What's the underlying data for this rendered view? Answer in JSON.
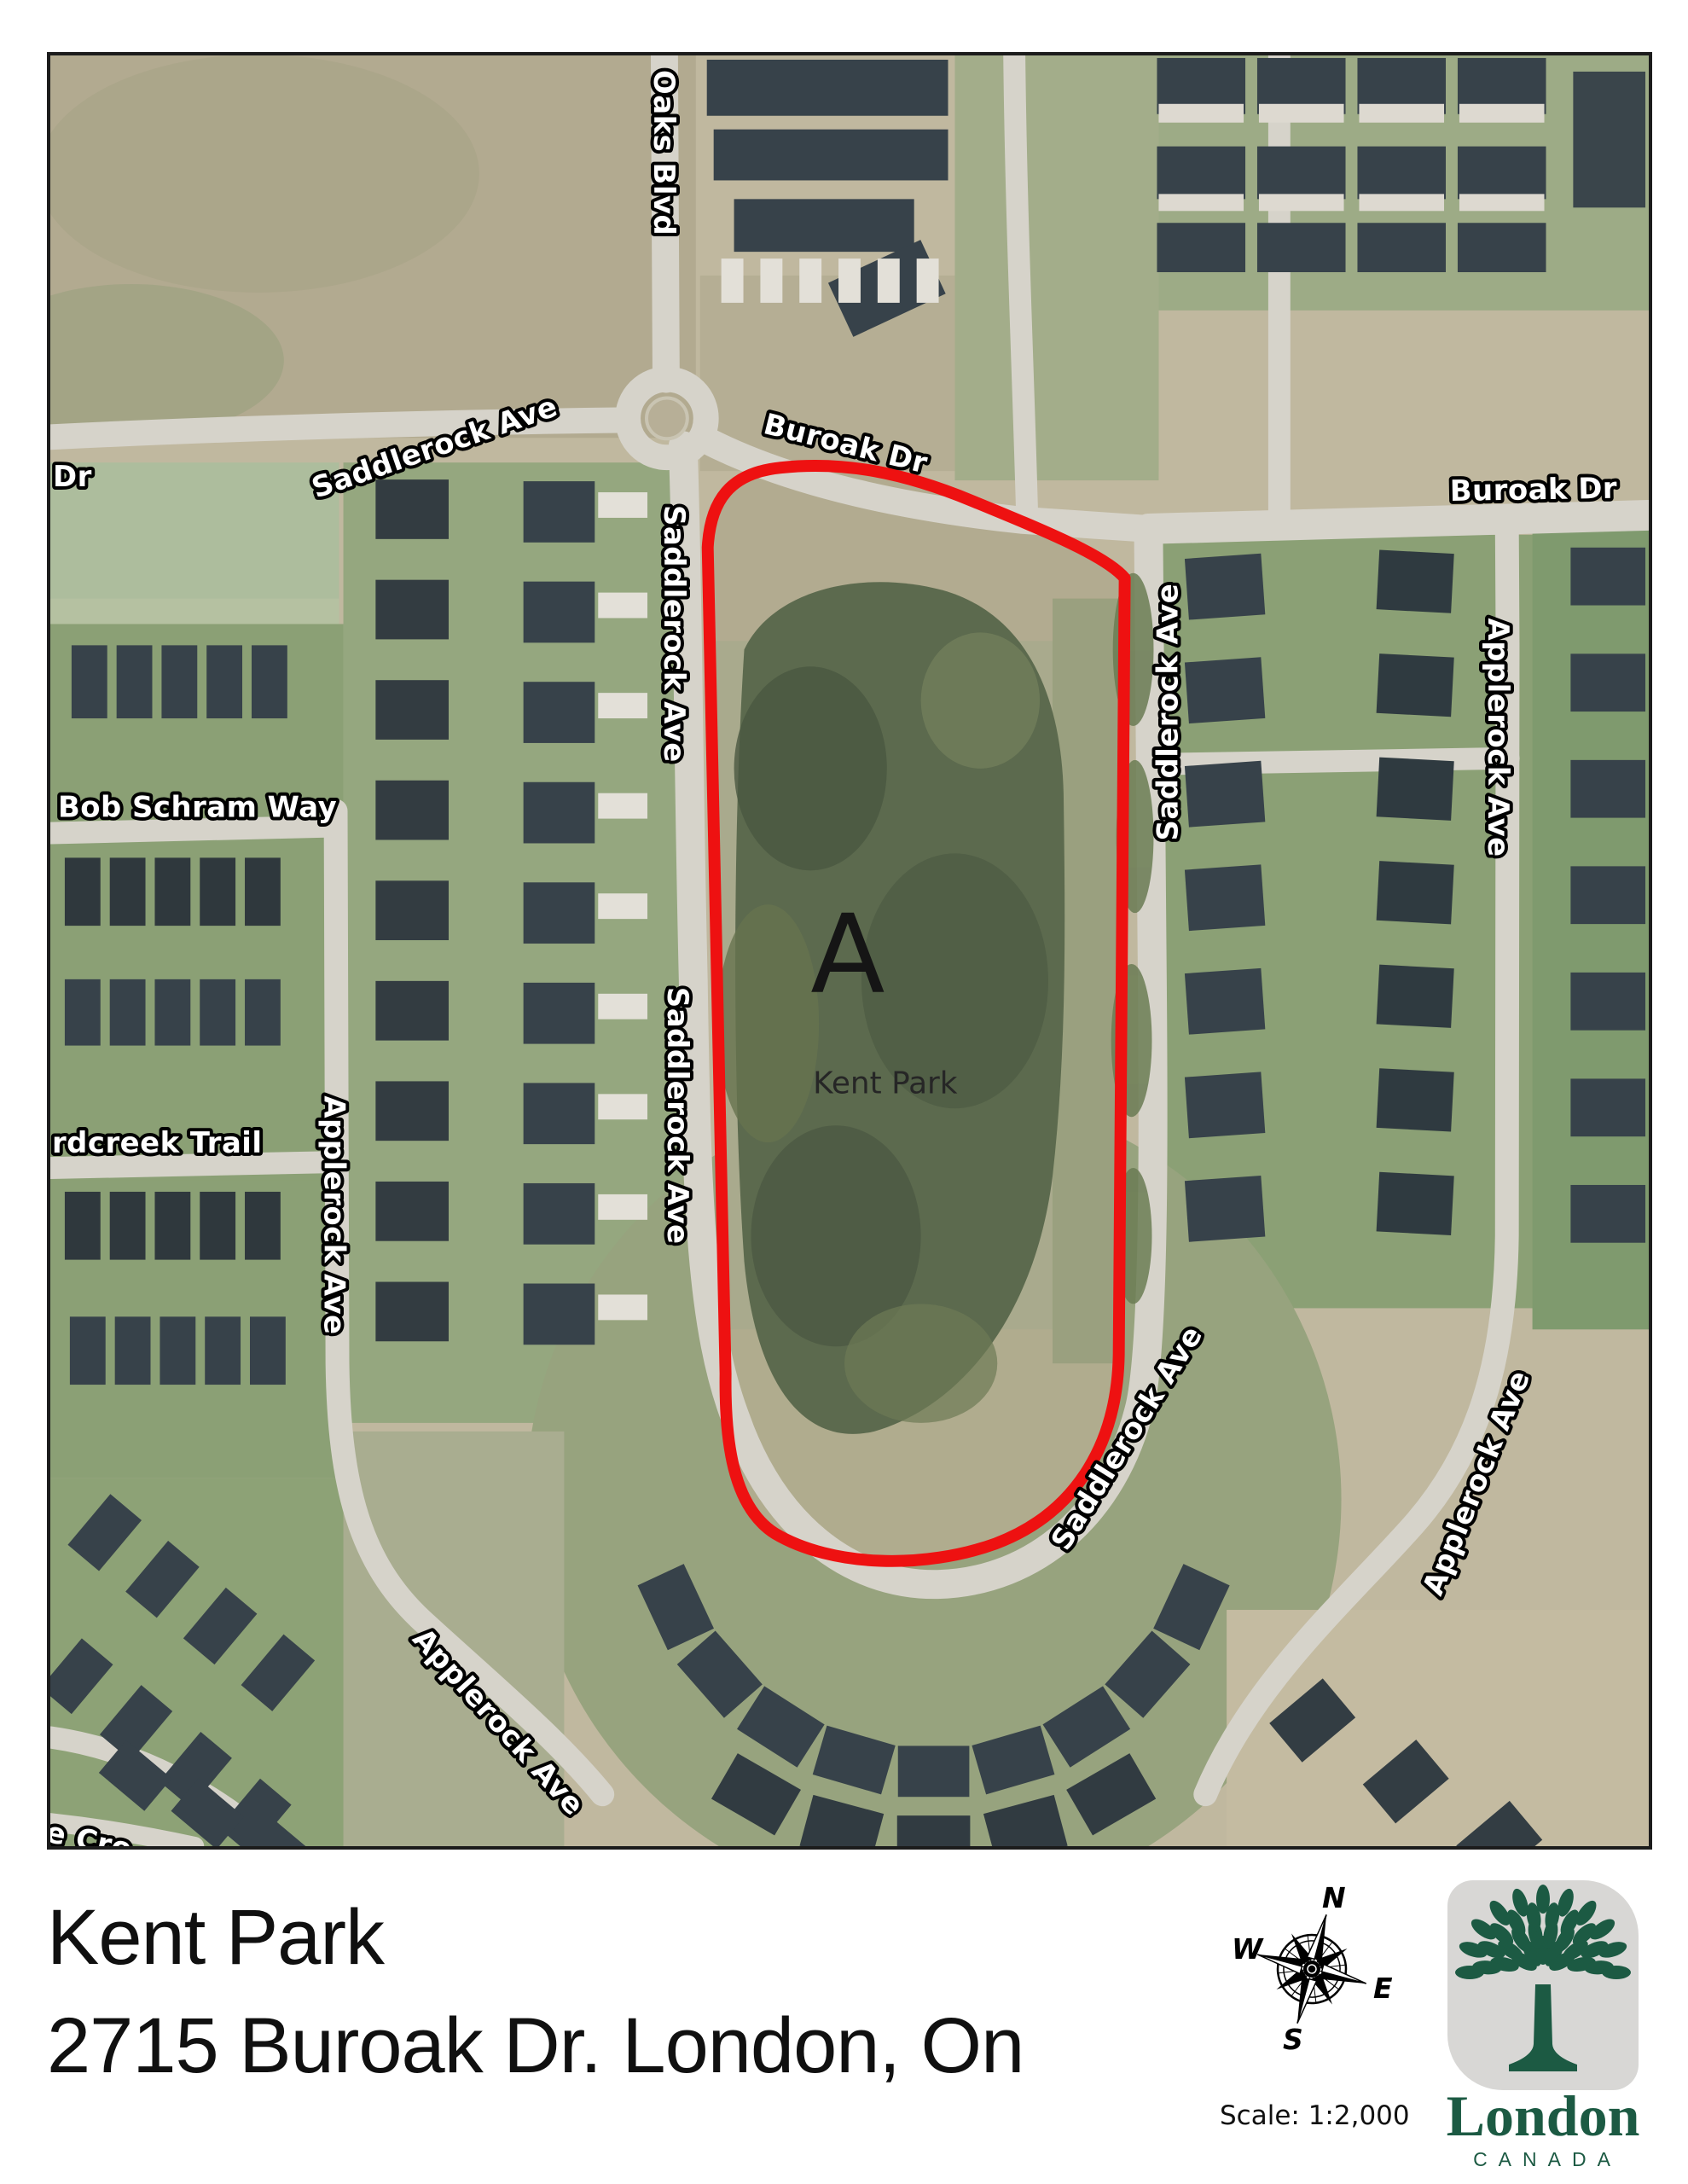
{
  "map": {
    "labels": {
      "oaks_blvd": "Oaks Blvd",
      "saddlerock_nw": "Saddlerock Ave",
      "dr_left": "Dr",
      "buroak_diag": "Buroak Dr",
      "buroak_right": "Buroak Dr",
      "saddlerock_w_upper": "Saddlerock Ave",
      "saddlerock_w_lower": "Saddlerock Ave",
      "saddlerock_e": "Saddlerock Ave",
      "saddlerock_se": "Saddlerock Ave",
      "bob_schram": "Bob Schram Way",
      "rdcreek": "rdcreek Trail",
      "applerock_w": "Applerock Ave",
      "applerock_sw": "Applerock Ave",
      "applerock_e": "Applerock Ave",
      "applerock_se": "Applerock Ave",
      "cres_sw": "e Cro",
      "zone_a": "A",
      "park_name": "Kent Park"
    },
    "parcel_color": "#ee1111"
  },
  "footer": {
    "title_line1": "Kent Park",
    "title_line2": "2715 Buroak Dr. London, On",
    "scale_label": "Scale: 1:2,000",
    "compass": {
      "n": "N",
      "e": "E",
      "s": "S",
      "w": "W"
    },
    "logo": {
      "wordmark": "London",
      "country": "CANADA",
      "brand_color": "#1c5a43"
    }
  }
}
